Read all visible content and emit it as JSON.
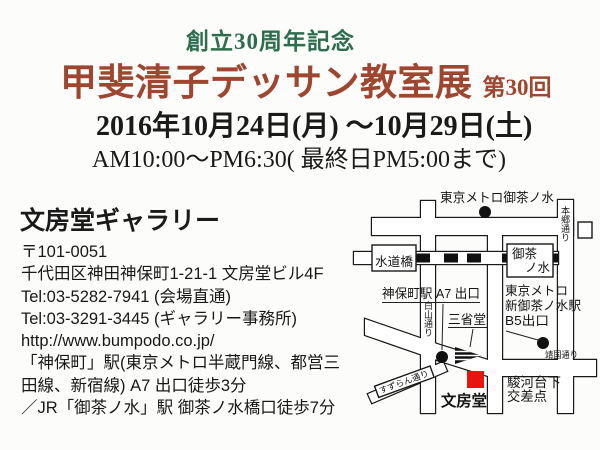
{
  "colors": {
    "accent_green": "#2c6e4c",
    "accent_red": "#9e4630",
    "map_marker_red": "#e8150f"
  },
  "header": {
    "anniversary": "創立30周年記念",
    "title": "甲斐清子デッサン教室展",
    "title_suffix": "第30回",
    "date_line": "2016年10月24日(月) 〜10月29日(土)",
    "time_line": "AM10:00〜PM6:30( 最終日PM5:00まで)"
  },
  "venue": {
    "name": "文房堂ギャラリー",
    "postal": "〒101-0051",
    "address": "千代田区神田神保町1-21-1  文房堂ビル4F",
    "tel_venue": "Tel:03-5282-7941 (会場直通)",
    "tel_office": "Tel:03-3291-3445 (ギャラリー事務所)",
    "url": "http://www.bumpodo.co.jp/",
    "access_line1": "「神保町」駅(東京メトロ半蔵門線、都営三",
    "access_line2": "田線、新宿線) A7 出口徒歩3分",
    "access_line3": "／JR「御茶ノ水」駅 御茶ノ水橋口徒歩7分"
  },
  "map": {
    "labels": {
      "metro_ochanomizu": "東京メトロ御茶ノ水",
      "suidobashi": "水道橋",
      "ochanomizu_1": "御茶",
      "ochanomizu_2": "ノ水",
      "hongo_dori": "本郷通り",
      "jimbocho_exit": "神保町駅 A7 出口",
      "hakusan_dori": "白山通り",
      "sanseido": "三省堂",
      "shin_ochanomizu_1": "東京メトロ",
      "shin_ochanomizu_2": "新御茶ノ水駅",
      "shin_ochanomizu_3": "B5出口",
      "yasukuni_dori": "靖国通り",
      "suzuran_dori": "すずらん通り",
      "bumpodo": "文房堂",
      "surugadai_1": "駿河台下",
      "surugadai_2": "交差点"
    }
  }
}
